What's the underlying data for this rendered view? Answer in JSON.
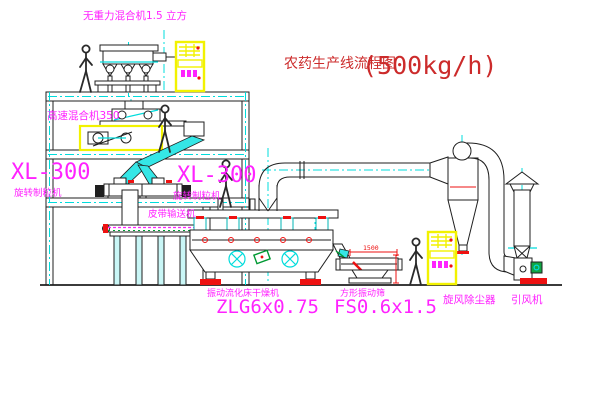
{
  "title": {
    "prefix": "农药生产线流程图",
    "capacity": "(500kg/h)"
  },
  "labels": {
    "top_mixer": "无重力混合机1.5 立方",
    "highspeed_mixer": "高速混合机350",
    "granulator_left_model": "XL-300",
    "granulator_left_name": "旋转制粒机",
    "granulator_right_model": "XL-300",
    "granulator_right_name": "旋转制粒机",
    "belt_conveyor": "皮带输送机",
    "dryer_name": "振动流化床干燥机",
    "dryer_model": "ZLG6x0.75",
    "screen_name": "方形振动筛",
    "screen_model": "FS0.6x1.5",
    "cyclone": "旋风除尘器",
    "fan": "引风机"
  },
  "dimensions": {
    "screen_width": "1500"
  },
  "colors": {
    "line": "#1f1f1f",
    "label_magenta": "#ff22ff",
    "title_red": "#cc2b2b",
    "centerline_cyan": "#00dcdc",
    "cabinet_yellow": "#f2f200",
    "accent_red": "#ee1111",
    "motor_green": "#009933"
  }
}
